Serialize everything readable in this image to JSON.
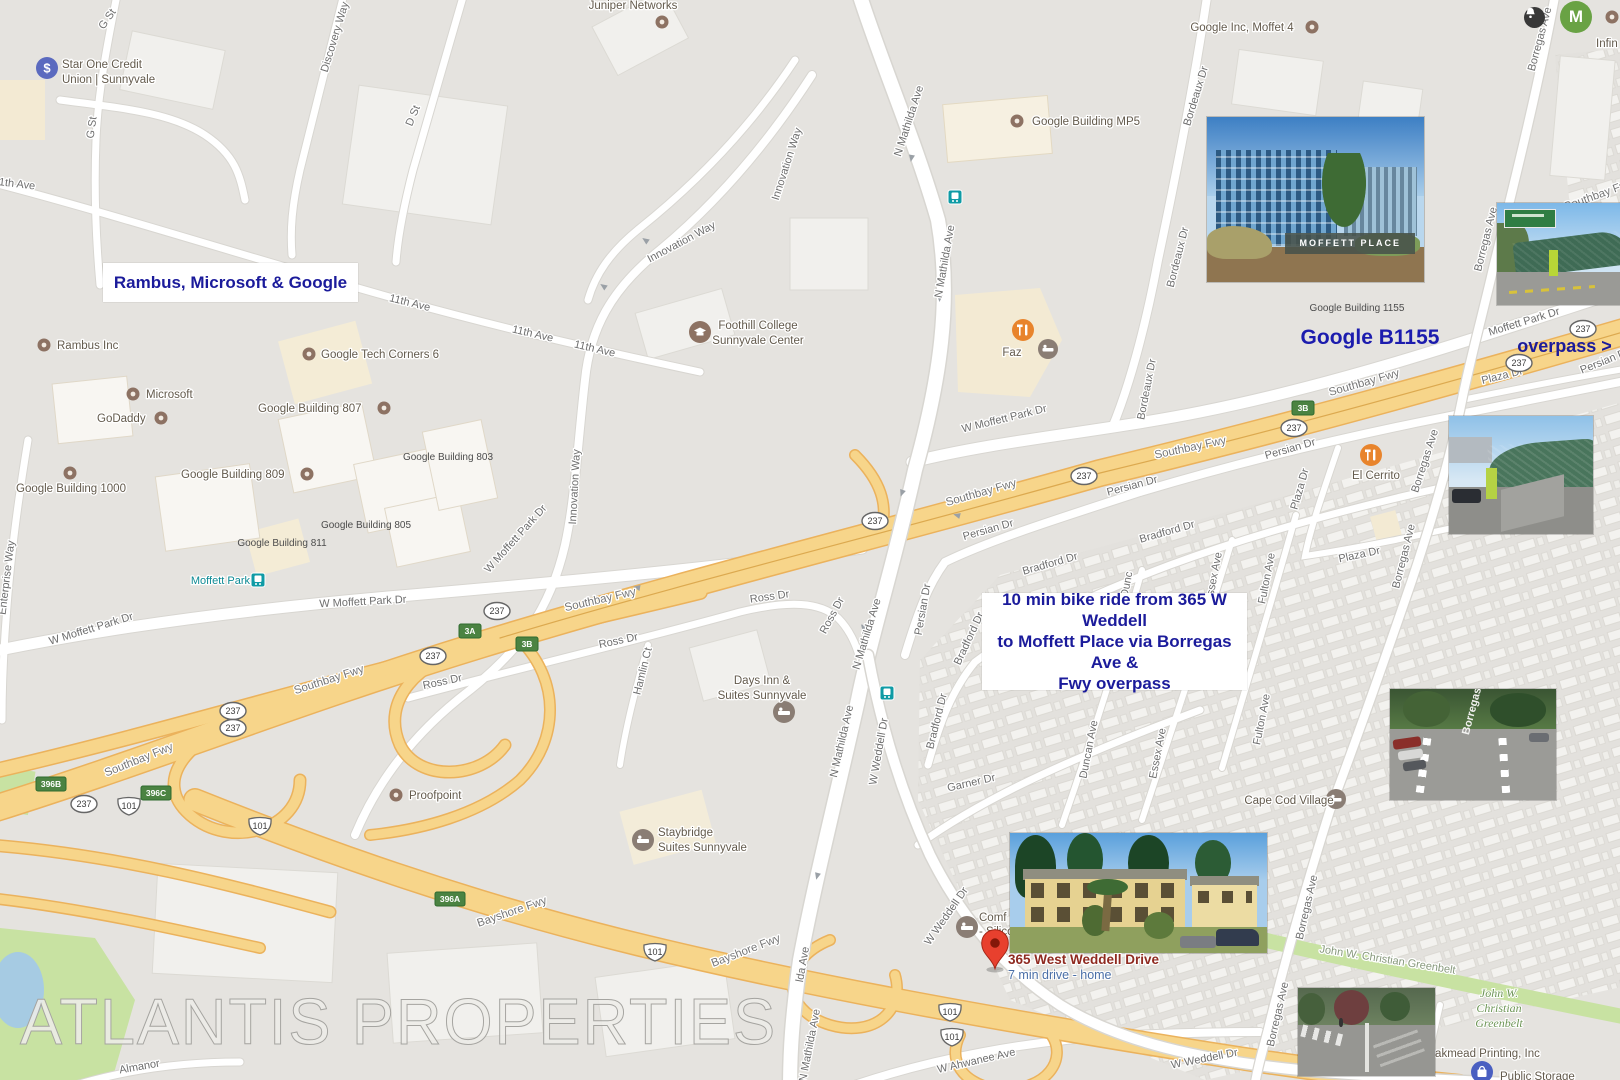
{
  "watermark": "ATLANTIS PROPERTIES",
  "ui": {
    "avatar_initial": "M"
  },
  "annotations": {
    "rambus_box": "Rambus, Microsoft & Google",
    "bike_1": "10 min bike ride from 365 W Weddell",
    "bike_2": "to Moffett Place via Borregas Ave &",
    "bike_3": "Fwy overpass",
    "google_b1155": "Google B1155",
    "overpass": "overpass >"
  },
  "pin": {
    "title": "365 West Weddell Drive",
    "subtitle": "7 min drive - home"
  },
  "streets": {
    "g_st": "G St",
    "discovery": "Discovery Way",
    "d_st": "D St",
    "eleventh": "11th Ave",
    "innovation": "Innovation Way",
    "mathilda": "N Mathilda Ave",
    "mathilda_frag": "lda Ave",
    "w_moffett": "W Moffett Park Dr",
    "moffett": "Moffett Park Dr",
    "southbay": "Southbay Fwy",
    "bayshore": "Bayshore Fwy",
    "ross": "Ross Dr",
    "hamlin": "Hamlin Ct",
    "weddell": "W Weddell Dr",
    "ahwanee": "W Ahwanee Ave",
    "persian": "Persian Dr",
    "bradford": "Bradford Dr",
    "garner": "Garner Dr",
    "duncan": "Duncan Ave",
    "duncan_frag": "Dunc",
    "essex": "Essex Ave",
    "fulton": "Fulton Ave",
    "plaza": "Plaza Dr",
    "borregas": "Borregas Ave",
    "bordeaux": "Bordeaux Dr",
    "enterprise": "Enterprise Way",
    "almanor": "Almanor",
    "greenbelt": "John W. Christian Greenbelt"
  },
  "pois": {
    "star_one_1": "Star One Credit",
    "star_one_2": "Union | Sunnyvale",
    "juniper": "Juniper Networks",
    "moffet4": "Google Inc, Moffet 4",
    "mp5": "Google Building MP5",
    "faz": "Faz",
    "foothill_1": "Foothill College",
    "foothill_2": "Sunnyvale Center",
    "rambus": "Rambus Inc",
    "microsoft": "Microsoft",
    "godaddy": "GoDaddy",
    "g1000": "Google Building 1000",
    "gtc6": "Google Tech Corners 6",
    "g807": "Google Building 807",
    "g809": "Google Building 809",
    "g803": "Google Building 803",
    "g805": "Google Building 805",
    "g811": "Google Building 811",
    "proofpoint": "Proofpoint",
    "daysinn_1": "Days Inn &",
    "daysinn_2": "Suites Sunnyvale",
    "staybridge_1": "Staybridge",
    "staybridge_2": "Suites Sunnyvale",
    "el_cerrito": "El Cerrito",
    "cape_cod": "Cape Cod Village",
    "comfort_frag1": "Comf",
    "comfort_frag2": "- Silico",
    "oakmead": "Oakmead Printing, Inc",
    "public_storage": "Public Storage",
    "infinera_frag": "Infin",
    "g1155_caption": "Google Building 1155",
    "greenbelt_1": "John W.",
    "greenbelt_2": "Christian",
    "greenbelt_3": "Greenbelt"
  },
  "transit": {
    "station": "Moffett Park"
  },
  "shields": {
    "r237": "237",
    "us101": "101",
    "e3a": "3A",
    "e3b": "3B",
    "e396a": "396A",
    "e396b": "396B",
    "e396c": "396C"
  },
  "photos": {
    "moffett_place_sign": "MOFFETT PLACE",
    "borregas_road_marking": "Borregas"
  },
  "colors": {
    "background": "#e5e3df",
    "road": "#ffffff",
    "freeway": "#f7d58a",
    "annotation_blue": "#1b1b9b",
    "pin_red": "#e8402e",
    "transit_teal": "#0f9ba5",
    "park_green": "#c8e2a2",
    "poi_brown": "#8d7263"
  }
}
